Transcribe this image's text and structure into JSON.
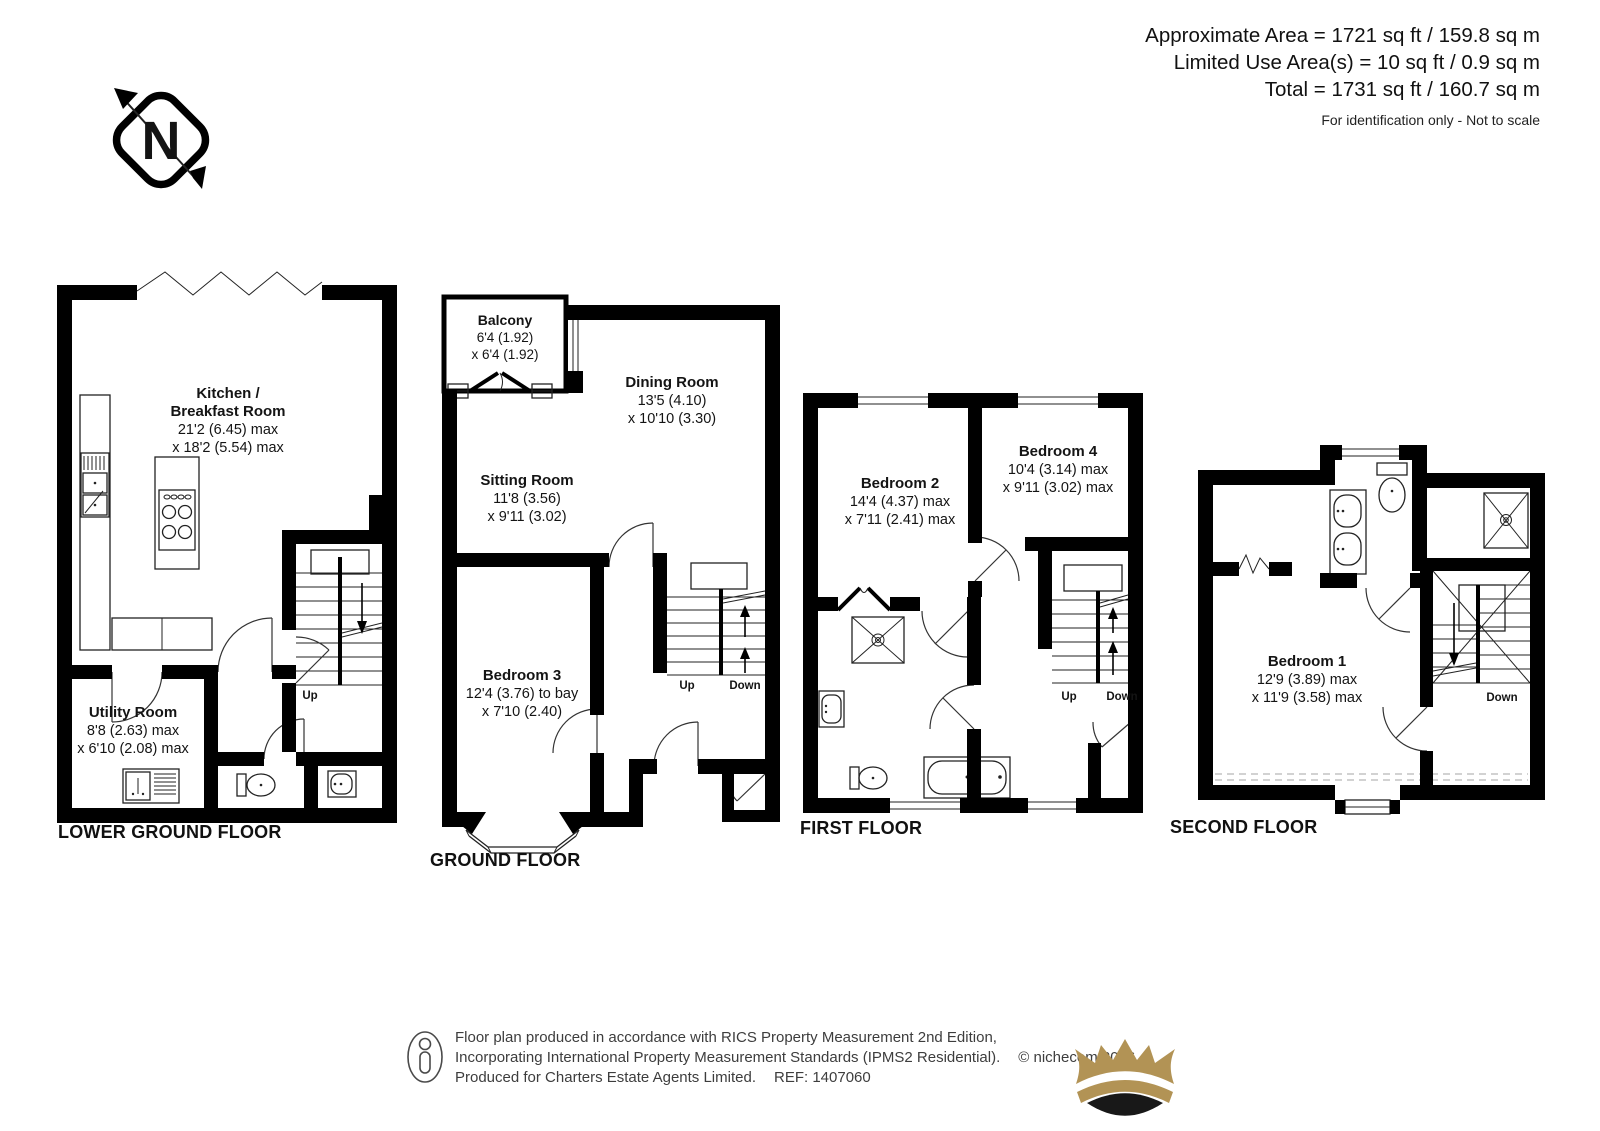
{
  "header": {
    "area_line_1": "Approximate Area = 1721 sq ft / 159.8 sq m",
    "area_line_2": "Limited Use Area(s) = 10 sq ft / 0.9 sq m",
    "area_line_3": "Total = 1731 sq ft / 160.7 sq m",
    "disclaimer": "For identification only - Not to scale"
  },
  "compass": {
    "north_label": "N"
  },
  "floors": {
    "lower_ground": {
      "label": "LOWER GROUND FLOOR",
      "kitchen": {
        "name1": "Kitchen /",
        "name2": "Breakfast Room",
        "dim1": "21'2 (6.45) max",
        "dim2": "x 18'2 (5.54) max"
      },
      "utility": {
        "name": "Utility Room",
        "dim1": "8'8 (2.63) max",
        "dim2": "x 6'10 (2.08) max"
      },
      "stairs_up": "Up"
    },
    "ground": {
      "label": "GROUND FLOOR",
      "balcony": {
        "name": "Balcony",
        "dim1": "6'4 (1.92)",
        "dim2": "x 6'4 (1.92)"
      },
      "dining": {
        "name": "Dining Room",
        "dim1": "13'5 (4.10)",
        "dim2": "x 10'10 (3.30)"
      },
      "sitting": {
        "name": "Sitting Room",
        "dim1": "11'8 (3.56)",
        "dim2": "x 9'11 (3.02)"
      },
      "bedroom3": {
        "name": "Bedroom 3",
        "dim1": "12'4 (3.76) to bay",
        "dim2": "x 7'10 (2.40)"
      },
      "stairs_up": "Up",
      "stairs_down": "Down"
    },
    "first": {
      "label": "FIRST FLOOR",
      "bedroom2": {
        "name": "Bedroom 2",
        "dim1": "14'4 (4.37) max",
        "dim2": "x 7'11 (2.41) max"
      },
      "bedroom4": {
        "name": "Bedroom 4",
        "dim1": "10'4 (3.14) max",
        "dim2": "x 9'11 (3.02) max"
      },
      "stairs_up": "Up",
      "stairs_down": "Down"
    },
    "second": {
      "label": "SECOND FLOOR",
      "bedroom1": {
        "name": "Bedroom 1",
        "dim1": "12'9 (3.89) max",
        "dim2": "x 11'9 (3.58) max"
      },
      "stairs_down": "Down"
    }
  },
  "footer": {
    "line1": "Floor plan produced in accordance with RICS Property Measurement 2nd Edition,",
    "line2": "Incorporating International Property Measurement Standards (IPMS2 Residential).",
    "copyright": "© nichecom 2026.",
    "produced_for": "Produced for Charters Estate Agents Limited.",
    "ref": "REF: 1407060",
    "logo_colors": {
      "crown_gold": "#B29355",
      "crown_dark": "#181818"
    }
  }
}
